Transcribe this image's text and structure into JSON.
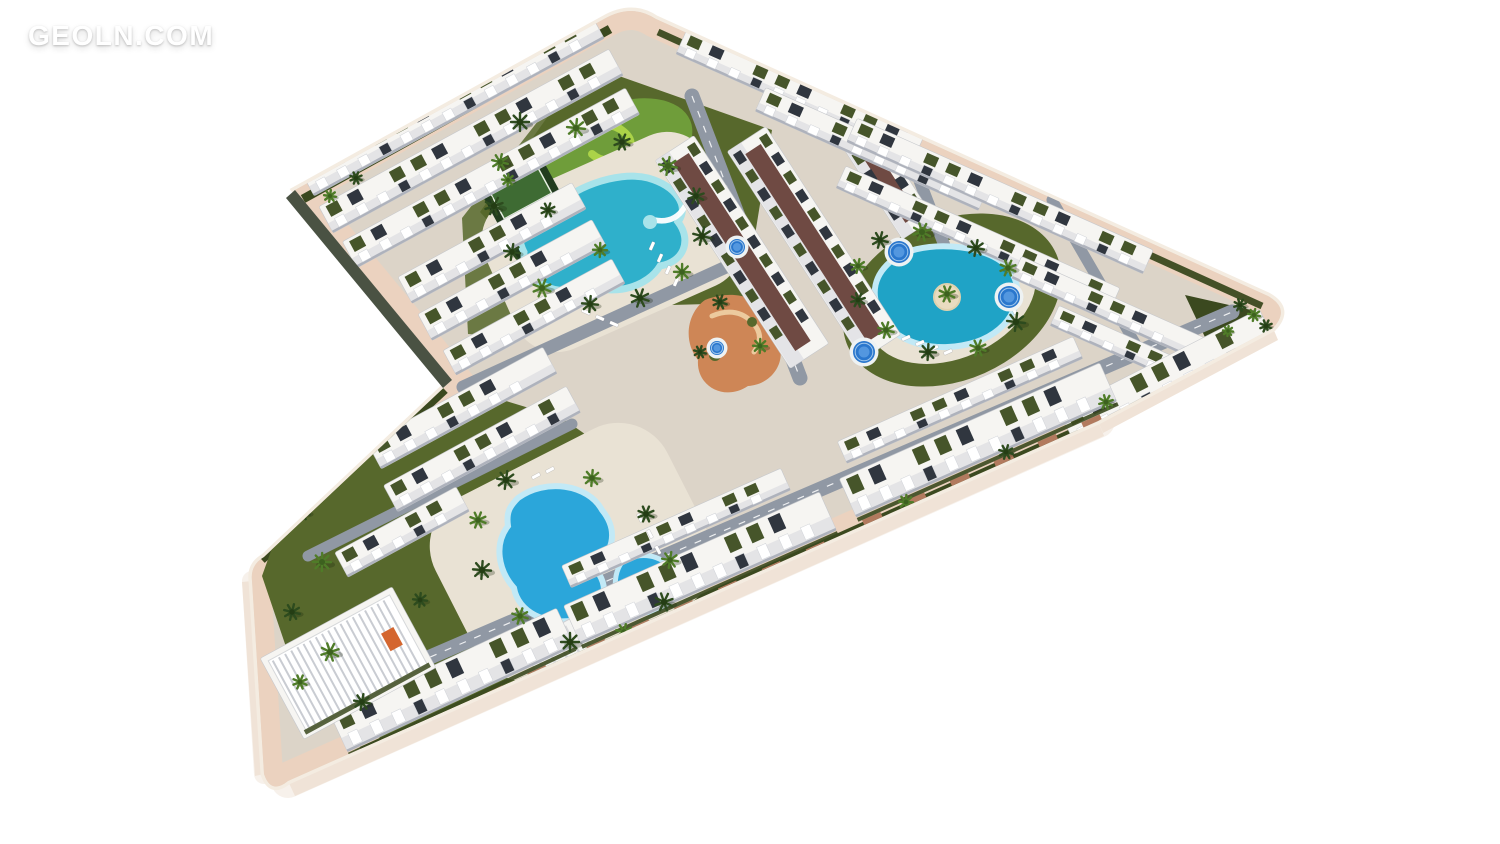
{
  "watermark": {
    "text": "GEOLN.COM"
  },
  "palette": {
    "bg": "#ffffff",
    "curb": "#f4ece1",
    "sidewalk": "#ebd2bf",
    "base": "#dcd4c8",
    "deck": "#e9e2d4",
    "asphalt": "#9098a4",
    "hedge": "#3b491f",
    "lawn": "#57682c",
    "golfLawn": "#6f9d3a",
    "golf": "#abd348",
    "poolDeep": "#2fb0cb",
    "poolRim": "#a8e3ea",
    "poolBlue": "#2ba6da",
    "poolBlueRim": "#c2e9f6",
    "heart": "#1fa3c6",
    "spa": "#2a77cd",
    "bldg": "#f6f5f2",
    "bldgShade": "#dddde2",
    "win": "#30363f",
    "roof": "#46552a",
    "paver": "#b27a5e",
    "court": "#6f4a43",
    "plaza": "#ce8656",
    "plazaPath": "#ecca9e",
    "palmA": "#2d4b1e",
    "palmB": "#4f7c28",
    "wall": "#4a5243",
    "slab": "#f0e3d7",
    "sand": "#e9dcc0",
    "courtA": "#223c1e",
    "courtB": "#3e6b33"
  },
  "scene": {
    "buildings": [
      [
        452,
        104,
        330,
        30,
        -28.5,
        "row"
      ],
      [
        471,
        141,
        330,
        30,
        -28.5,
        "row"
      ],
      [
        491,
        178,
        322,
        30,
        -28.5,
        "row"
      ],
      [
        492,
        243,
        198,
        30,
        -28.5,
        "row"
      ],
      [
        512,
        280,
        198,
        30,
        -28.5,
        "row"
      ],
      [
        534,
        317,
        192,
        28,
        -28.5,
        "row"
      ],
      [
        742,
        252,
        248,
        46,
        57,
        "block"
      ],
      [
        814,
        243,
        248,
        46,
        57,
        "block"
      ],
      [
        884,
        176,
        126,
        38,
        57,
        "block"
      ],
      [
        800,
        95,
        260,
        26,
        24,
        "row"
      ],
      [
        872,
        149,
        244,
        26,
        24,
        "row"
      ],
      [
        1000,
        196,
        324,
        26,
        24,
        "row"
      ],
      [
        978,
        238,
        300,
        24,
        24,
        "row"
      ],
      [
        1108,
        308,
        200,
        24,
        24,
        "row"
      ],
      [
        1114,
        342,
        130,
        22,
        24,
        "row"
      ],
      [
        1168,
        378,
        225,
        40,
        -27,
        "pav"
      ],
      [
        978,
        440,
        285,
        42,
        -24,
        "pav"
      ],
      [
        700,
        568,
        280,
        42,
        -24,
        "pav"
      ],
      [
        452,
        680,
        250,
        42,
        -25,
        "pav"
      ],
      [
        960,
        400,
        258,
        24,
        -24,
        "row"
      ],
      [
        676,
        528,
        240,
        24,
        -24,
        "row"
      ],
      [
        462,
        408,
        200,
        30,
        -28.5,
        "row"
      ],
      [
        482,
        449,
        208,
        30,
        -28.5,
        "row"
      ],
      [
        402,
        532,
        138,
        28,
        -28.5,
        "row"
      ],
      [
        348,
        663,
        150,
        92,
        -28.5,
        "club"
      ]
    ],
    "streets": [
      [
        692,
        96,
        800,
        378,
        15
      ],
      [
        897,
        122,
        950,
        260,
        12
      ],
      [
        386,
        676,
        1232,
        312,
        15
      ],
      [
        463,
        387,
        737,
        262,
        13
      ],
      [
        308,
        556,
        572,
        424,
        11
      ],
      [
        1052,
        200,
        1146,
        362,
        11
      ]
    ],
    "spas": [
      [
        899,
        252,
        11
      ],
      [
        1009,
        297,
        11
      ],
      [
        864,
        352,
        11
      ],
      [
        737,
        247,
        8
      ],
      [
        717,
        348,
        7
      ]
    ],
    "loungers": [
      [
        652,
        246,
        -66
      ],
      [
        660,
        258,
        -66
      ],
      [
        668,
        270,
        -66
      ],
      [
        676,
        282,
        -66
      ],
      [
        586,
        312,
        24
      ],
      [
        600,
        318,
        24
      ],
      [
        614,
        324,
        24
      ],
      [
        906,
        338,
        -24
      ],
      [
        920,
        343,
        -24
      ],
      [
        934,
        348,
        -24
      ],
      [
        948,
        352,
        -24
      ],
      [
        1014,
        310,
        66
      ],
      [
        1020,
        296,
        66
      ],
      [
        536,
        476,
        -28
      ],
      [
        550,
        470,
        -28
      ],
      [
        640,
        518,
        62
      ],
      [
        650,
        534,
        62
      ],
      [
        658,
        550,
        62
      ]
    ],
    "palms": [
      [
        520,
        122,
        9,
        0
      ],
      [
        500,
        162,
        8,
        1
      ],
      [
        494,
        206,
        9,
        0
      ],
      [
        512,
        252,
        8,
        0
      ],
      [
        542,
        288,
        9,
        1
      ],
      [
        590,
        304,
        8,
        0
      ],
      [
        640,
        298,
        9,
        0
      ],
      [
        682,
        272,
        8,
        1
      ],
      [
        702,
        236,
        9,
        0
      ],
      [
        696,
        196,
        8,
        0
      ],
      [
        668,
        166,
        9,
        1
      ],
      [
        622,
        142,
        8,
        0
      ],
      [
        576,
        128,
        9,
        1
      ],
      [
        548,
        210,
        7,
        0
      ],
      [
        600,
        250,
        7,
        1
      ],
      [
        880,
        240,
        8,
        0
      ],
      [
        922,
        232,
        9,
        1
      ],
      [
        976,
        248,
        8,
        0
      ],
      [
        1008,
        268,
        8,
        1
      ],
      [
        1016,
        322,
        9,
        0
      ],
      [
        978,
        348,
        8,
        1
      ],
      [
        928,
        352,
        8,
        0
      ],
      [
        886,
        330,
        8,
        1
      ],
      [
        858,
        300,
        7,
        0
      ],
      [
        858,
        266,
        7,
        1
      ],
      [
        947,
        294,
        8,
        1
      ],
      [
        506,
        480,
        9,
        0
      ],
      [
        478,
        520,
        8,
        1
      ],
      [
        482,
        570,
        9,
        0
      ],
      [
        520,
        616,
        8,
        1
      ],
      [
        570,
        642,
        9,
        0
      ],
      [
        624,
        632,
        8,
        1
      ],
      [
        664,
        602,
        9,
        0
      ],
      [
        670,
        560,
        8,
        1
      ],
      [
        646,
        514,
        8,
        0
      ],
      [
        592,
        478,
        8,
        1
      ],
      [
        302,
        512,
        8,
        0
      ],
      [
        322,
        562,
        9,
        1
      ],
      [
        292,
        612,
        8,
        0
      ],
      [
        330,
        652,
        9,
        1
      ],
      [
        362,
        702,
        8,
        0
      ],
      [
        300,
        682,
        7,
        1
      ],
      [
        420,
        600,
        7,
        0
      ],
      [
        720,
        302,
        7,
        0
      ],
      [
        760,
        346,
        7,
        1
      ],
      [
        700,
        352,
        6,
        0
      ],
      [
        1240,
        305,
        6,
        0
      ],
      [
        1254,
        315,
        6,
        1
      ],
      [
        1266,
        326,
        6,
        0
      ],
      [
        1228,
        331,
        5,
        1
      ],
      [
        806,
        560,
        7,
        0
      ],
      [
        906,
        502,
        7,
        1
      ],
      [
        1006,
        452,
        7,
        0
      ],
      [
        1106,
        402,
        7,
        1
      ],
      [
        556,
        682,
        7,
        0
      ],
      [
        462,
        722,
        6,
        1
      ],
      [
        330,
        196,
        6,
        1
      ],
      [
        356,
        178,
        6,
        0
      ],
      [
        508,
        180,
        6,
        1
      ]
    ]
  }
}
